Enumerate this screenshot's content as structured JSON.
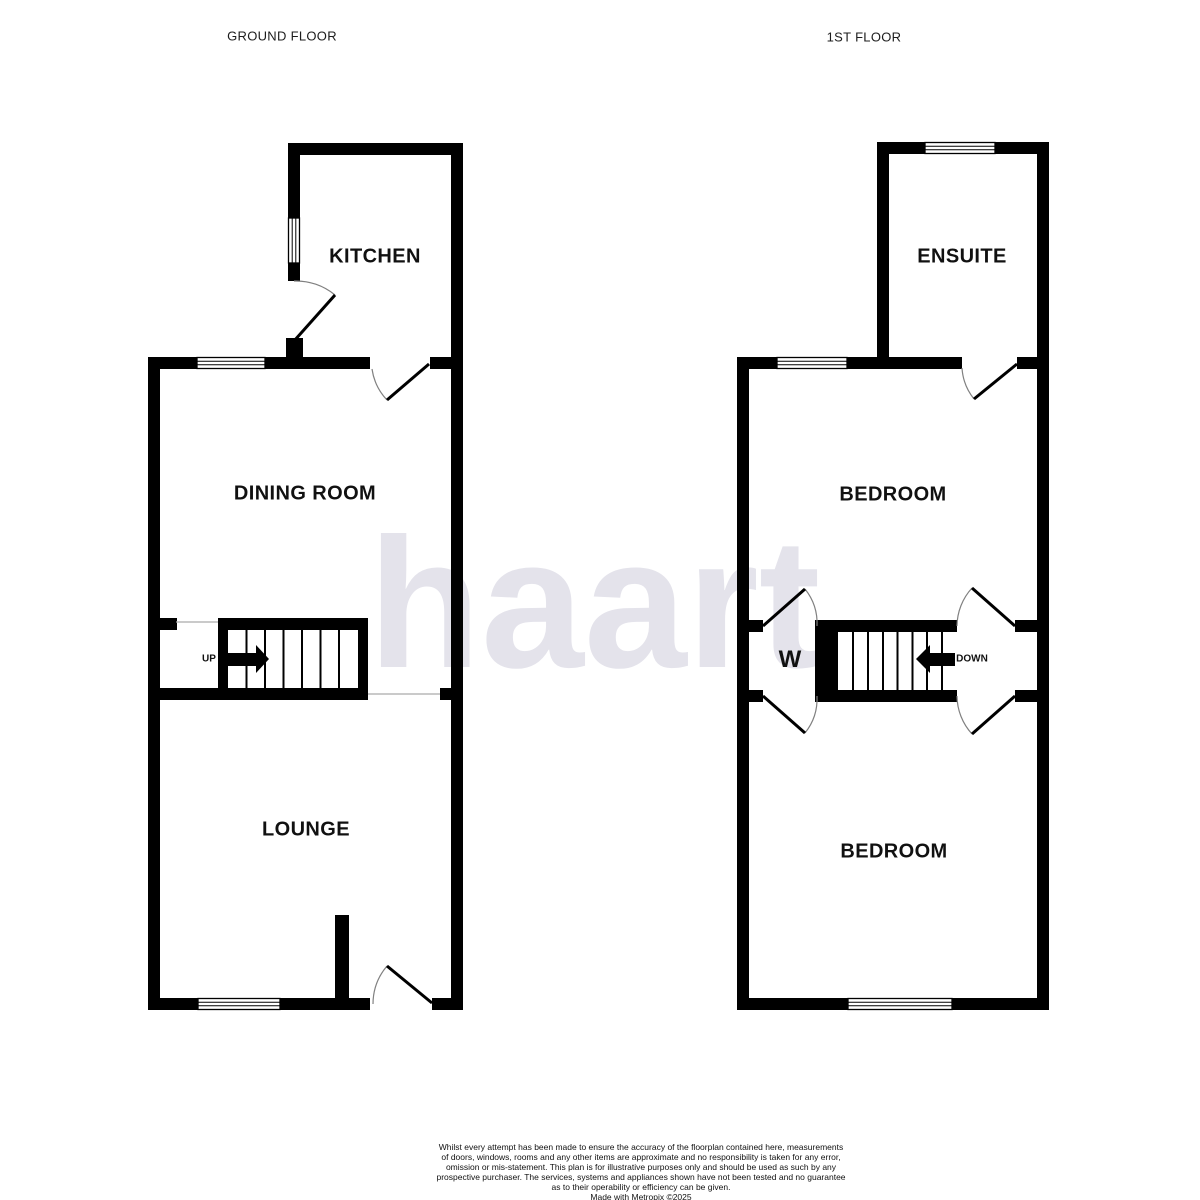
{
  "watermark": {
    "text": "haart",
    "color": "#e4e3eb"
  },
  "floors": {
    "ground": {
      "title": "GROUND FLOOR",
      "rooms": [
        {
          "id": "kitchen",
          "label": "KITCHEN"
        },
        {
          "id": "dining-room",
          "label": "DINING ROOM"
        },
        {
          "id": "lounge",
          "label": "LOUNGE"
        }
      ],
      "stairs_label": "UP"
    },
    "first": {
      "title": "1ST FLOOR",
      "rooms": [
        {
          "id": "ensuite",
          "label": "ENSUITE"
        },
        {
          "id": "bedroom-front",
          "label": "BEDROOM"
        },
        {
          "id": "bedroom-back",
          "label": "BEDROOM"
        }
      ],
      "stairs_label": "DOWN",
      "wardrobe_label": "W"
    }
  },
  "footer": {
    "disclaimer_lines": [
      "Whilst every attempt has been made to ensure the accuracy of the floorplan contained here, measurements",
      "of doors, windows, rooms and any other items are approximate and no responsibility is taken for any error,",
      "omission or mis-statement. This plan is for illustrative purposes only and should be used as such by any",
      "prospective purchaser. The services, systems and appliances shown have not been tested and no guarantee",
      "as to their operability or efficiency can be given."
    ],
    "credit": "Made with Metropix ©2025"
  },
  "colors": {
    "wall": "#000000",
    "door_arc": "#808080",
    "opening_line": "#aaaaaa",
    "watermark": "#e4e3eb"
  }
}
